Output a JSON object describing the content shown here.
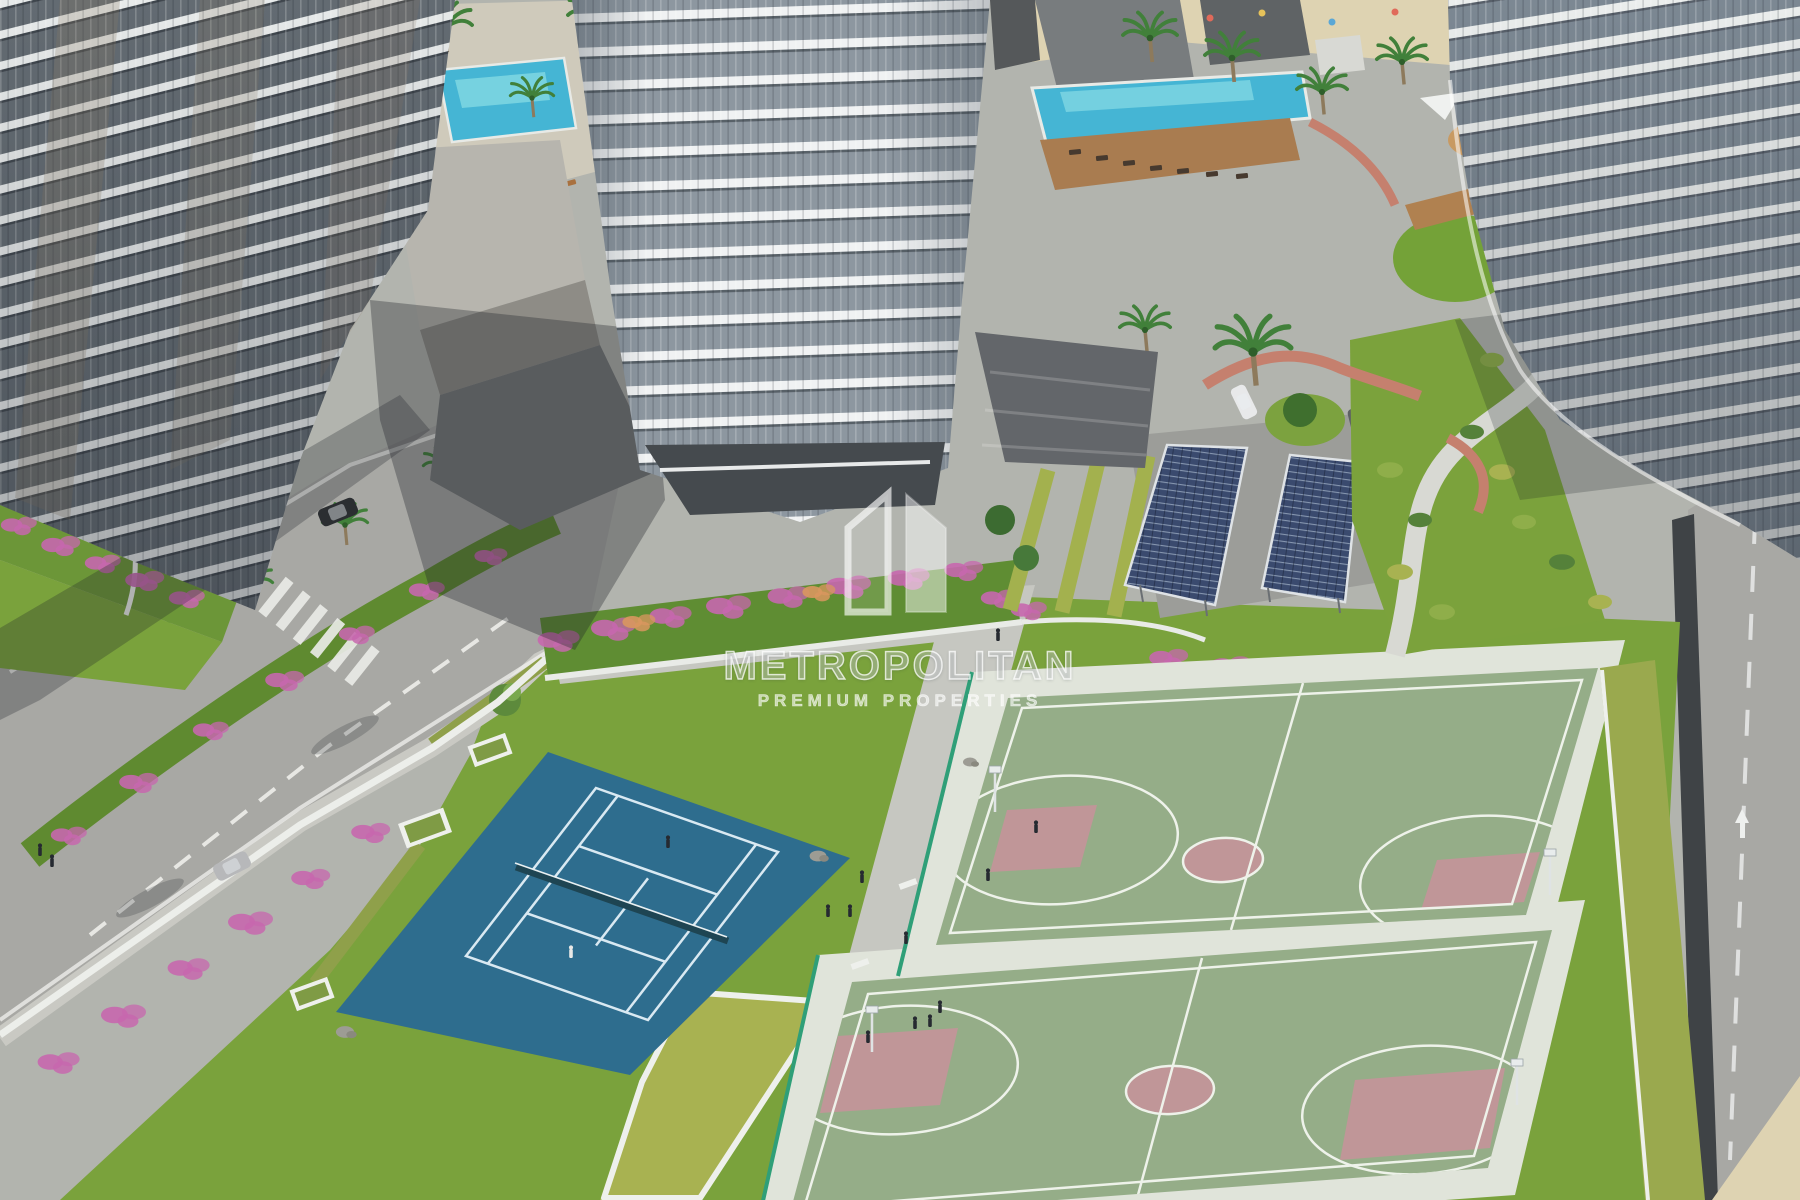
{
  "watermark": {
    "logo_icon": "metropolitan-building-logo-icon",
    "title": "METROPOLITAN",
    "subtitle": "PREMIUM PROPERTIES"
  },
  "scene": {
    "description": "aerial rendering of residential towers with tennis court, two basketball courts, solar carports, pools and landscaped gardens"
  },
  "colors": {
    "tennis_court": "#2e6d8e",
    "tennis_line": "#d9e9f2",
    "basketball_surface": "#95ad88",
    "basketball_key": "#c09698",
    "court_apron": "#e0e4da",
    "grass": "#7aa23c",
    "hedge_yellow_green": "#a8b251",
    "road": "#a8a8a4",
    "sidewalk": "#c9c9c3",
    "sand": "#ded3b2",
    "pool_water": "#45b5d4",
    "solar_panel": "#3a4a6e",
    "flower_pink": "#c767ae",
    "terracotta_wall": "#c5806e",
    "building_band_white": "#f0f2f3",
    "building_glass": "#8d97a0",
    "dark_wall": "#3f4346"
  }
}
